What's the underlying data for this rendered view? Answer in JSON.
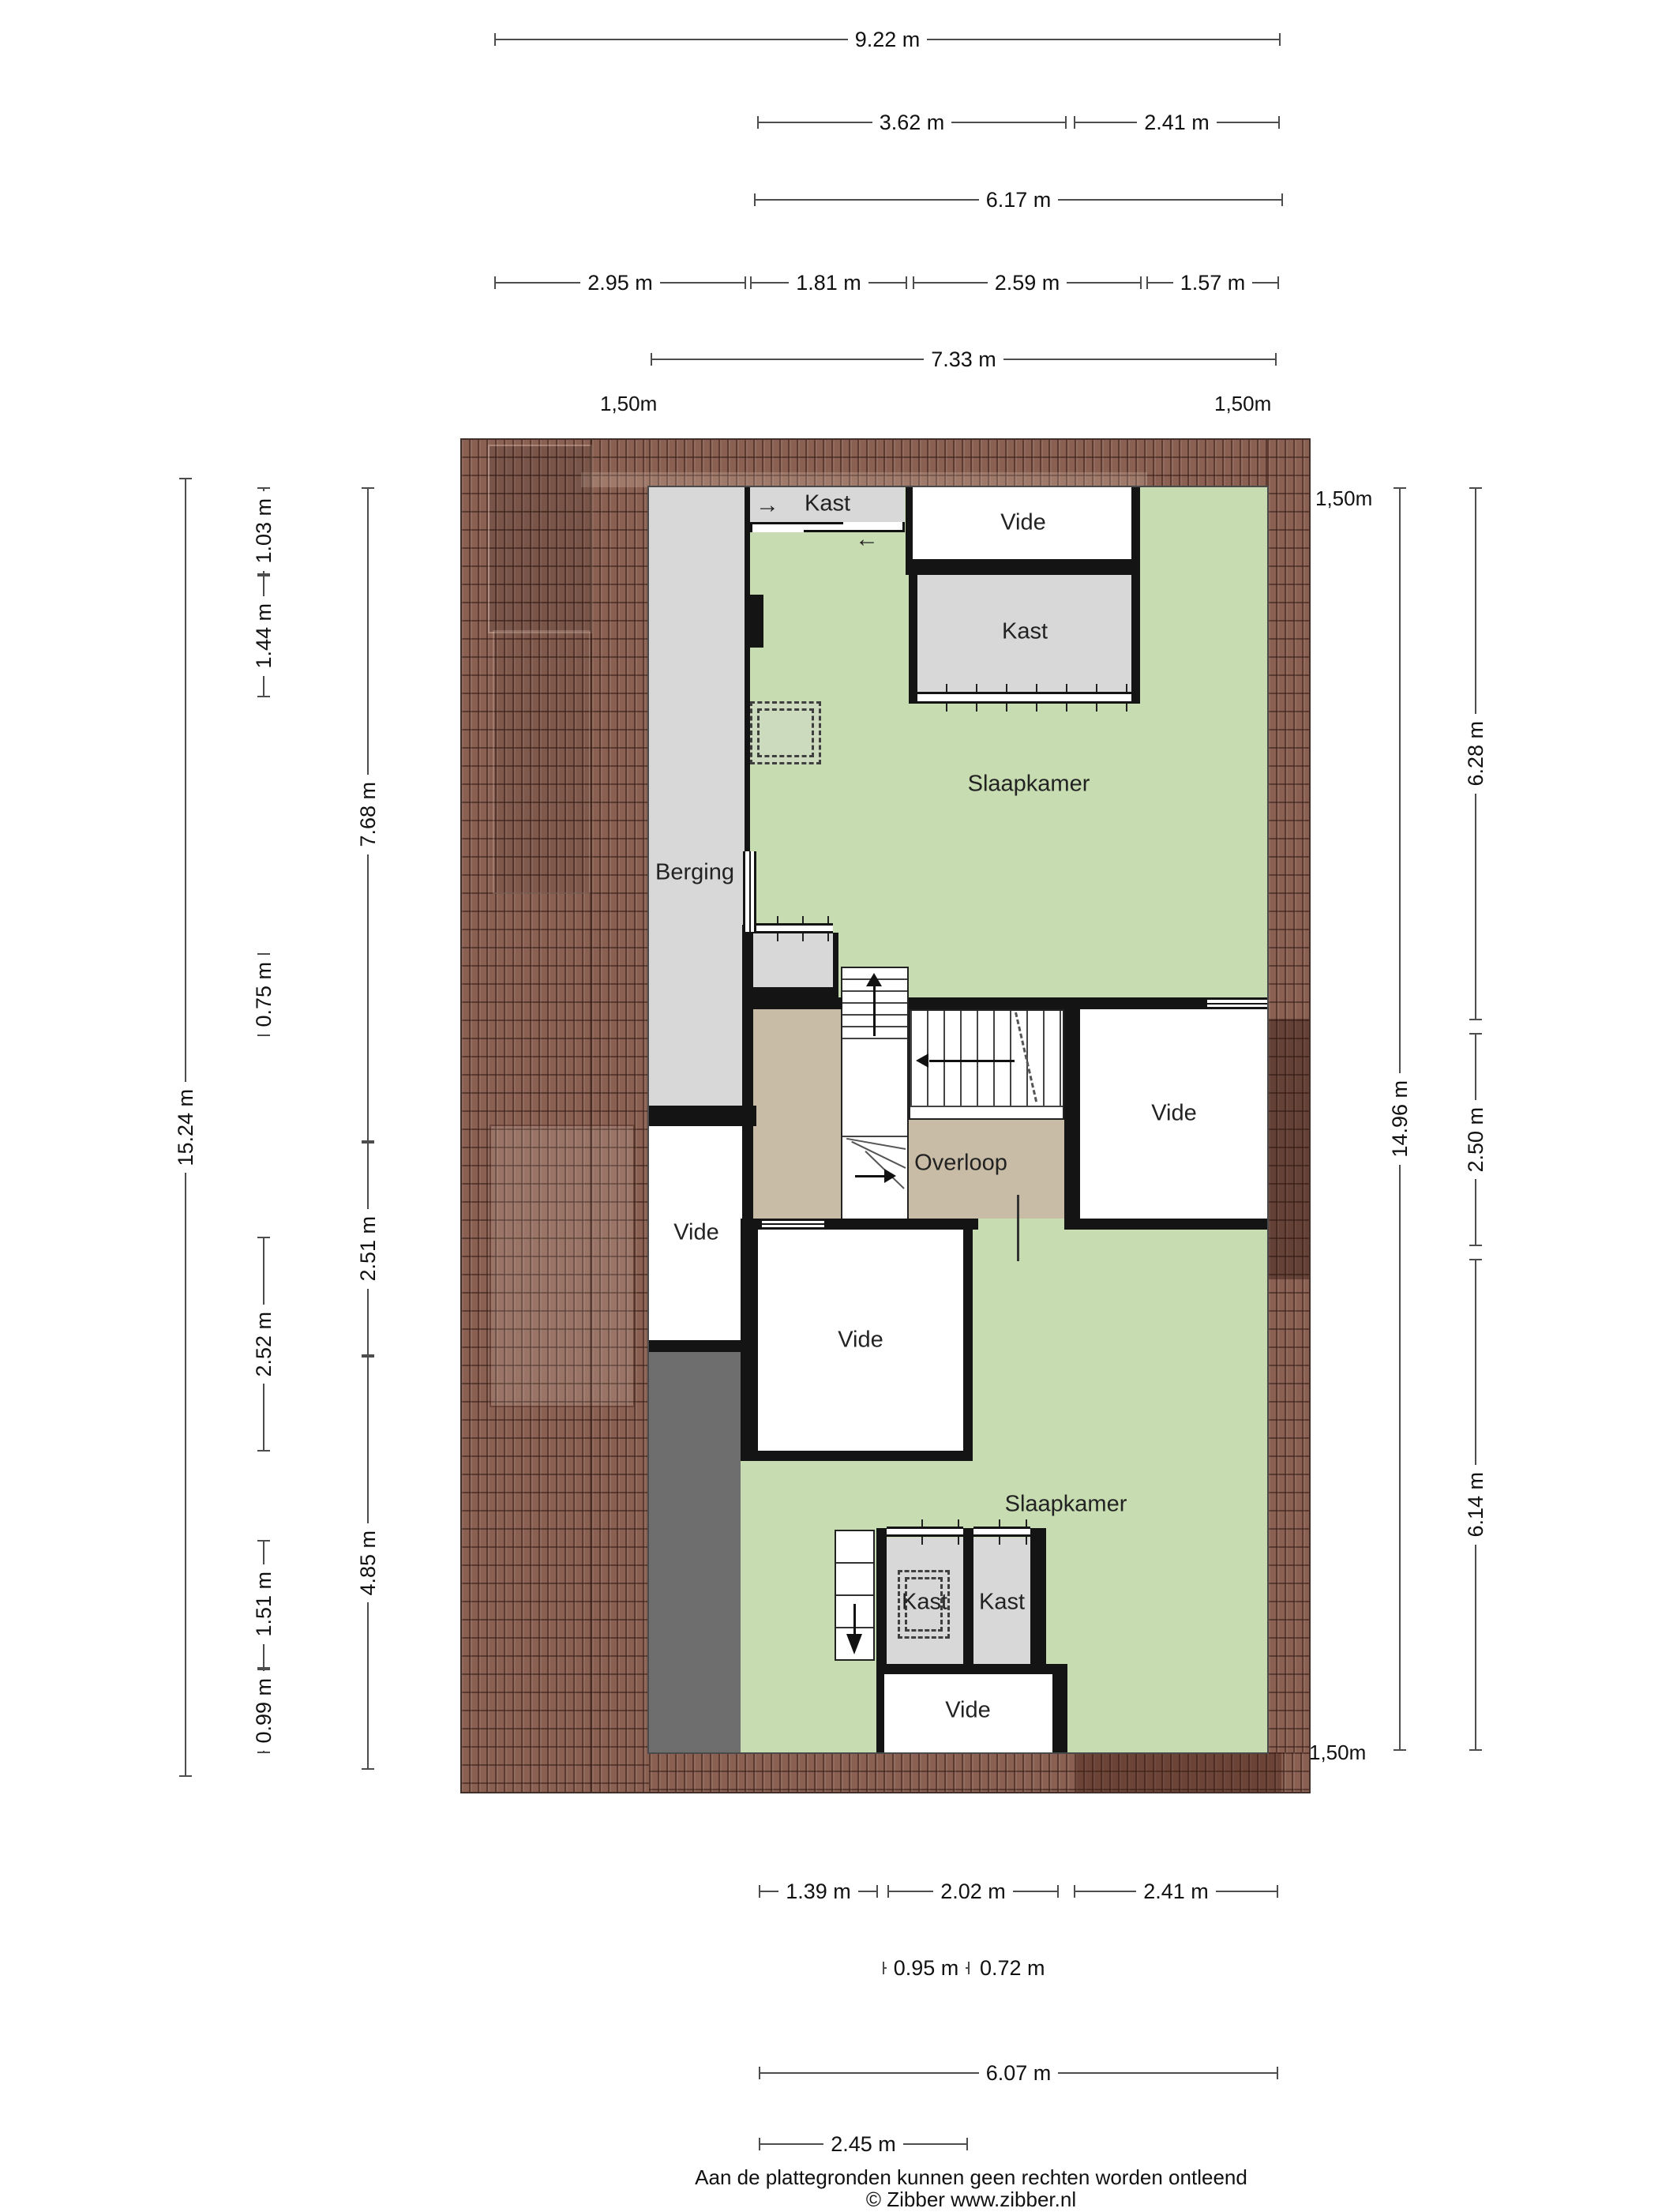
{
  "floorplan": {
    "rooms": {
      "kast_top": "Kast",
      "vide_top": "Vide",
      "kast_upper": "Kast",
      "slaapkamer_upper": "Slaapkamer",
      "berging": "Berging",
      "vide_left": "Vide",
      "vide_right": "Vide",
      "overloop": "Overloop",
      "vide_middle": "Vide",
      "slaapkamer_lower": "Slaapkamer",
      "kast_lower_left": "Kast",
      "kast_lower_right": "Kast",
      "vide_bottom": "Vide"
    },
    "height_marker": "1,50m",
    "icons": {
      "arrow_right": "→",
      "arrow_left": "←"
    },
    "colors": {
      "room_green": "#c7dcb1",
      "room_gray": "#d8d8d8",
      "overloop_tan": "#c8bca6",
      "roof_brown": "#8a6053",
      "dark_strip_gray": "#6e6e6e",
      "wall_black": "#141414"
    }
  },
  "dimensions": {
    "top": {
      "total": "9.22 m",
      "row2": [
        "3.62 m",
        "2.41 m"
      ],
      "row3": "6.17 m",
      "row4": [
        "2.95 m",
        "1.81 m",
        "2.59 m",
        "1.57 m"
      ],
      "row5": "7.33 m"
    },
    "left": {
      "total": "15.24 m",
      "inner": [
        "1.03 m",
        "1.44 m",
        "0.75 m",
        "2.52 m",
        "1.51 m",
        "0.99 m"
      ],
      "mid": [
        "7.68 m",
        "2.51 m",
        "4.85 m"
      ]
    },
    "right": {
      "total": "14.96 m",
      "inner": [
        "6.28 m",
        "2.50 m",
        "6.14 m"
      ]
    },
    "bottom": {
      "row1": [
        "1.39 m",
        "2.02 m",
        "2.41 m"
      ],
      "row2": [
        "0.95 m",
        "0.72 m"
      ],
      "row3": "6.07 m",
      "row4": "2.45 m"
    }
  },
  "footer": {
    "disclaimer": "Aan de plattegronden kunnen geen rechten worden ontleend",
    "copyright": "© Zibber www.zibber.nl"
  }
}
